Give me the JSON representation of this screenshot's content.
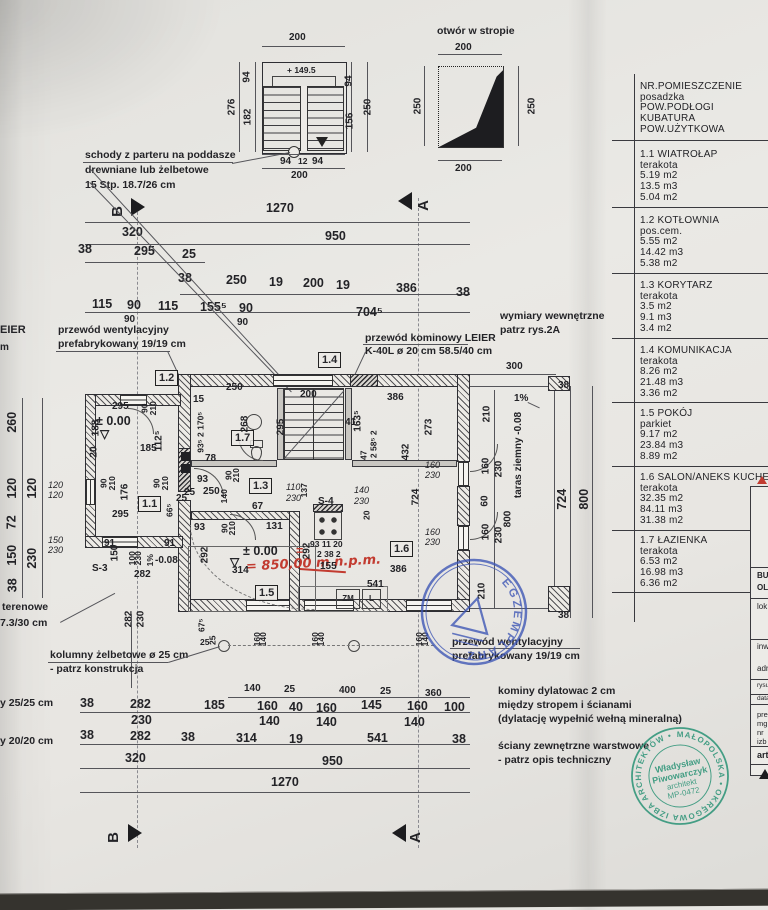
{
  "stairs_detail": {
    "dim_top": "200",
    "level": "+ 149.5",
    "left_a": "94",
    "left_b": "182",
    "left_total": "276",
    "right_a": "94",
    "right_b": "156",
    "right_total": "250",
    "bottom_a": "94",
    "bottom_b": "12",
    "bottom_c": "94",
    "bottom_total": "200",
    "note1": "schody z parteru na poddasze",
    "note2": "drewniane lub żelbetowe",
    "note3": "15 Stp. 18.7/26 cm"
  },
  "opening_detail": {
    "title": "otwór w stropie",
    "top": "200",
    "left": "250",
    "right": "250",
    "bottom": "200"
  },
  "markers": {
    "a": "A",
    "b": "B"
  },
  "top_dims": {
    "r1": [
      "1270"
    ],
    "r2": [
      "320",
      "950"
    ],
    "r3": [
      "38",
      "295",
      "25"
    ],
    "r4": [
      "38",
      "250",
      "19",
      "200",
      "19",
      "386",
      "38"
    ],
    "r5": [
      "115",
      "90",
      "115",
      "155⁵",
      "90",
      "704⁵"
    ],
    "r6": [
      "90",
      "90"
    ]
  },
  "ann": {
    "vent1a": "przewód wentylacyjny",
    "vent1b": "prefabrykowany 19/19 cm",
    "chim1": "przewód kominowy LEIER",
    "chim2": "K-40L ø 20 cm 58.5/40 cm",
    "int1": "wymiary wewnętrzne",
    "int2": "patrz rys.2A",
    "edge1": "EIER",
    "edge2": "m",
    "terr1": "terenowe",
    "terr2": "7.3/30 cm",
    "col1": "kolumny żelbetowe ø 25 cm",
    "col2": "- patrz konstrukcja",
    "marg1": "y 25/25 cm",
    "marg2": "y 20/20 cm",
    "vent2a": "przewód wentylacyjny",
    "vent2b": "prefabrykowany 19/19 cm",
    "kom1": "kominy dylatowac 2 cm",
    "kom2": "między stropem i ścianami",
    "kom3": "(dylatację wypełnić wełną mineralną)",
    "sci1": "ściany zewnętrzne warstwowe",
    "sci2": "- patrz opis techniczny"
  },
  "plan": {
    "rooms": {
      "r11": "1.1",
      "r12": "1.2",
      "r13": "1.3",
      "r14": "1.4",
      "r15": "1.5",
      "r16": "1.6",
      "r17": "1.7"
    },
    "level_entry": "± 0.00",
    "level_main": "± 0.00",
    "red_eq": "=",
    "red_note": "= 850,00 m n.p.m.",
    "s3": "S-3",
    "s4": "S-4",
    "zm": "ZM",
    "l": "L",
    "dims": [
      "295",
      "188",
      "20",
      "185",
      "112⁵",
      "90",
      "210",
      "90",
      "210",
      "90",
      "210",
      "176",
      "295",
      "25",
      "66⁵",
      "250",
      "15",
      "93⁵ 2 170⁵",
      "78",
      "268",
      "200",
      "295",
      "41",
      "163⁵",
      "273",
      "432",
      "386",
      "2 58⁵ 2",
      "47",
      "93",
      "25",
      "250",
      "90",
      "210",
      "140",
      "67",
      "110",
      "230",
      "137",
      "140",
      "230",
      "20",
      "93",
      "131",
      "90",
      "210",
      "292",
      "292",
      "314",
      "91",
      "91",
      "150",
      "100",
      "230",
      "1%",
      "-0.08",
      "282",
      "120",
      "120",
      "150",
      "230",
      "93 11 20",
      "2 38 2",
      "155",
      "541",
      "386",
      "724",
      "160",
      "230",
      "160",
      "230"
    ]
  },
  "left_col": [
    "260",
    "120",
    "120",
    "72",
    "150",
    "230",
    "38"
  ],
  "terrace": {
    "taras": "taras ziemny  -0.08",
    "slope": "1%",
    "dims": [
      "300",
      "210",
      "160",
      "230",
      "60",
      "160",
      "230",
      "210",
      "800",
      "38",
      "724",
      "800",
      "38"
    ]
  },
  "bottom_dims": {
    "r0": [
      "140",
      "25",
      "400",
      "25",
      "360"
    ],
    "r1": [
      "38",
      "282",
      "185",
      "160",
      "40",
      "160",
      "145",
      "160",
      "100"
    ],
    "r2": [
      "230",
      "140",
      "140",
      "140"
    ],
    "r3": [
      "38",
      "282",
      "38",
      "314",
      "19",
      "541",
      "38"
    ],
    "r4": [
      "320",
      "950"
    ],
    "r5": [
      "1270"
    ],
    "below": [
      "282",
      "230",
      "67⁵",
      "25"
    ],
    "win": [
      "160",
      "140",
      "25",
      "160",
      "140",
      "160",
      "140"
    ]
  },
  "legend": {
    "header": [
      "NR.POMIESZCZENIE",
      "posadzka",
      "POW.PODŁOGI",
      "KUBATURA",
      "POW.UŻYTKOWA"
    ],
    "rooms": [
      {
        "name": "1.1 WIATROŁAP",
        "floor": "terakota",
        "area": "5.19 m2",
        "volume": "13.5 m3",
        "usable": "5.04 m2"
      },
      {
        "name": "1.2 KOTŁOWNIA",
        "floor": "pos.cem.",
        "area": "5.55 m2",
        "volume": "14.42 m3",
        "usable": "5.38 m2"
      },
      {
        "name": "1.3 KORYTARZ",
        "floor": "terakota",
        "area": "3.5 m2",
        "volume": "9.1 m3",
        "usable": "3.4 m2"
      },
      {
        "name": "1.4 KOMUNIKACJA",
        "floor": "terakota",
        "area": "8.26 m2",
        "volume": "21.48 m3",
        "usable": "3.36 m2"
      },
      {
        "name": "1.5 POKÓJ",
        "floor": "parkiet",
        "area": "9.17 m2",
        "volume": "23.84 m3",
        "usable": "8.89 m2"
      },
      {
        "name": "1.6 SALON/ANEKS KUCHENNY",
        "floor": "terakota",
        "area": "32.35 m2",
        "volume": "84.11 m3",
        "usable": "31.38 m2"
      },
      {
        "name": "1.7 ŁAZIENKA",
        "floor": "terakota",
        "area": "6.53 m2",
        "volume": "16.98 m3",
        "usable": "6.36 m2"
      }
    ]
  },
  "title_block": {
    "rows": [
      "BU",
      "OL",
      "lok",
      "inw",
      "adr",
      "rysu",
      "data:",
      "pre",
      "mg",
      "nr",
      "izb",
      "art"
    ]
  },
  "stamp_green": {
    "ring": "MAŁOPOLSKA • OKRĘGOWA IZBA ARCHITEKTÓW •",
    "l1": "Władysław",
    "l2": "Piwowarczyk",
    "l3": "architekt",
    "l4": "MP-0472",
    "color": "#2f9579"
  },
  "stamp_blue": {
    "ring": "EGZEMPLARZ",
    "color": "#3c55b5"
  }
}
